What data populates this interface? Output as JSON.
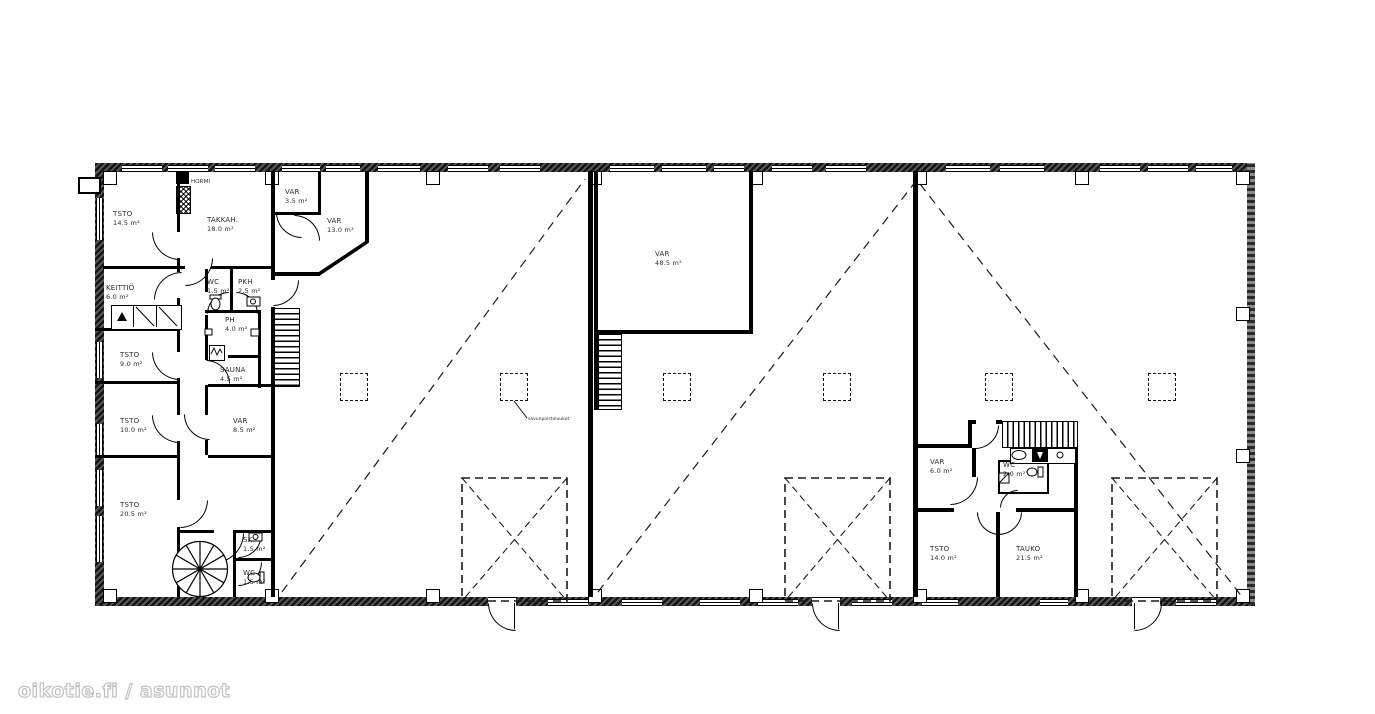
{
  "watermark": "oikotie.fi / asunnot",
  "plan": {
    "rooms": [
      {
        "name": "TSTO",
        "area": "14.5 m²"
      },
      {
        "name": "TAKKAH.",
        "area": "18.0 m²"
      },
      {
        "name": "VAR",
        "area": "3.5 m²"
      },
      {
        "name": "VAR",
        "area": "13.0 m²"
      },
      {
        "name": "KEITTIÖ",
        "area": "6.0 m²"
      },
      {
        "name": "WC",
        "area": "1.5 m²"
      },
      {
        "name": "PKH",
        "area": "2.5 m²"
      },
      {
        "name": "PH",
        "area": "4.0 m²"
      },
      {
        "name": "SAUNA",
        "area": "4.5 m²"
      },
      {
        "name": "TSTO",
        "area": "9.0 m²"
      },
      {
        "name": "TSTO",
        "area": "10.0 m²"
      },
      {
        "name": "VAR",
        "area": "8.5 m²"
      },
      {
        "name": "TSTO",
        "area": "20.5 m²"
      },
      {
        "name": "SK",
        "area": "1.5 m²"
      },
      {
        "name": "WC",
        "area": "1.5 m²"
      },
      {
        "name": "VAR",
        "area": "48.5 m²"
      },
      {
        "name": "VAR",
        "area": "6.0 m²"
      },
      {
        "name": "WC",
        "area": "2.0 m²"
      },
      {
        "name": "TSTO",
        "area": "14.0 m²"
      },
      {
        "name": "TAUKO",
        "area": "21.5 m²"
      }
    ],
    "annotations": {
      "hormi": "HORMI",
      "smoke_vent": "savunpoistoluukut"
    }
  }
}
